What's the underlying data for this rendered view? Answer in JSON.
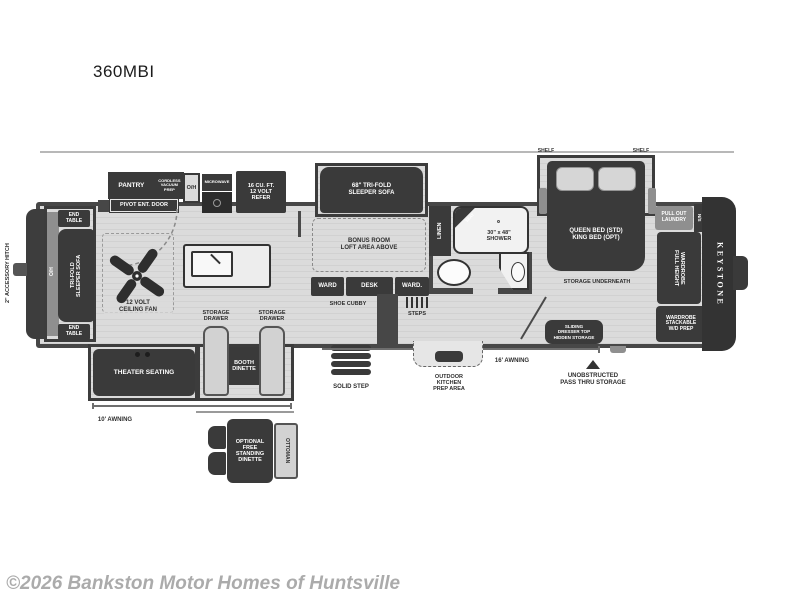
{
  "page": {
    "title": "360MBI",
    "watermark": "©2026 Bankston Motor Homes of Huntsville"
  },
  "colors": {
    "furniture_dark": "#3a3a3a",
    "wall_gray": "#474747",
    "floor_light": "#d9d9d9",
    "bench_light": "#d2d2d2",
    "watermark_gray": "#ababab"
  },
  "plan": {
    "labels": {
      "accessory_hitch": "2\" ACCESSORY HITCH",
      "end_table": "END\nTABLE",
      "oh": "O/H",
      "front_sofa": "TRI-FOLD\nSLEEPER SOFA",
      "pantry": "PANTRY",
      "cordless_vacuum": "CORDLESS\nVACUUM\nPREP",
      "pivot_door": "PIVOT ENT. DOOR",
      "microwave": "MICROWAVE",
      "refer": "16 CU. FT.\n12 VOLT\nREFER",
      "sofa68": "68\" TRI-FOLD\nSLEEPER SOFA",
      "bonus_room": "BONUS ROOM\nLOFT AREA ABOVE",
      "ceiling_fan": "12 VOLT\nCEILING FAN",
      "storage_drawer": "STORAGE\nDRAWER",
      "ward1": "WARD",
      "desk": "DESK",
      "ward2": "WARD.",
      "shoe_cubby": "SHOE CUBBY",
      "steps": "STEPS",
      "linen": "LINEN",
      "seat": "SEAT",
      "shower": "30\" x 48\"\nSHOWER",
      "shelf": "SHELF",
      "bed": "QUEEN BED (STD)\nKING BED (OPT)",
      "storage_underneath": "STORAGE UNDERNEATH",
      "pull_out_laundry": "PULL OUT\nLAUNDRY",
      "ns": "N/S",
      "full_height_wardrobe": "FULL HEIGHT\nWARDROBE",
      "keystone": "KEYSTONE",
      "wardrobe_wd": "WARDROBE\nSTACKABLE\nW/D PREP",
      "sliding_dresser": "SLIDING\nDRESSER TOP\nHIDDEN STORAGE",
      "unobstructed": "UNOBSTRUCTED\nPASS THRU STORAGE",
      "awning16": "16' AWNING",
      "awning10": "10' AWNING",
      "outdoor_kitchen": "OUTDOOR\nKITCHEN\nPREP AREA",
      "solid_step": "SOLID STEP",
      "theater": "THEATER SEATING",
      "booth": "BOOTH\nDINETTE",
      "opt_dinette": "OPTIONAL\nFREE\nSTANDING\nDINETTE",
      "ottoman": "OTTOMAN"
    }
  }
}
